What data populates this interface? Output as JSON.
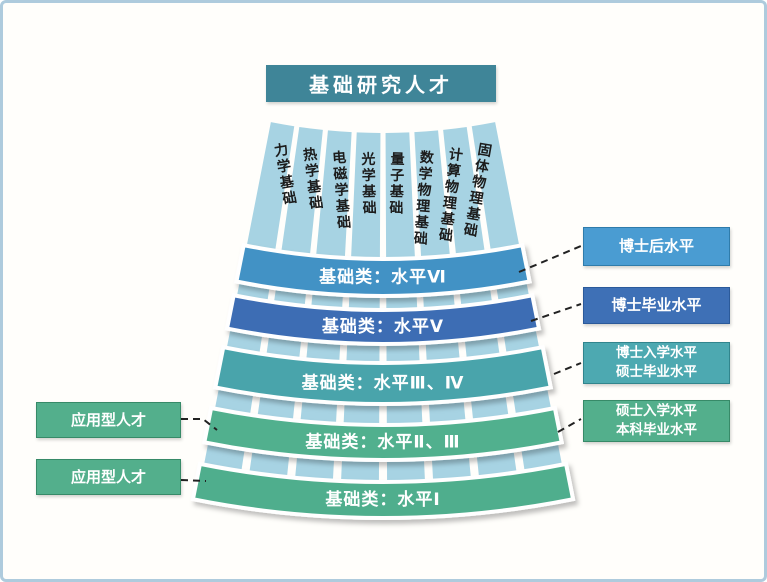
{
  "title": "基础研究人才",
  "fan": {
    "columns": [
      "力学基础",
      "热学基础",
      "电磁学基础",
      "光学基础",
      "量子基础",
      "数学物理基础",
      "计算物理基础",
      "固体物理基础"
    ],
    "bands": [
      "基础类：水平Ⅵ",
      "基础类：水平Ⅴ",
      "基础类：水平Ⅲ、Ⅳ",
      "基础类：水平Ⅱ、Ⅲ",
      "基础类：水平Ⅰ"
    ]
  },
  "right_labels": [
    {
      "lines": [
        "博士后水平"
      ]
    },
    {
      "lines": [
        "博士毕业水平"
      ]
    },
    {
      "lines": [
        "博士入学水平",
        "硕士毕业水平"
      ]
    },
    {
      "lines": [
        "硕士入学水平",
        "本科毕业水平"
      ]
    }
  ],
  "left_labels": [
    "应用型人才",
    "应用型人才"
  ],
  "colors": {
    "frame_border": "#aecbdd",
    "title_bg": "#3f8598",
    "column_fill": "#a7d3e3",
    "column_text": "#1c1c1c",
    "band_level_6": "#4292c5",
    "band_level_5": "#3d6db4",
    "band_level_3_4": "#48a4ab",
    "band_level_2_3": "#51b08e",
    "band_level_1": "#4fae8d",
    "right_box_1": "#4a9cd2",
    "right_box_2": "#3e70b6",
    "right_box_3": "#4da9b1",
    "right_box_4": "#53af8c",
    "left_box": "#53af8c",
    "connector": "#222222"
  }
}
